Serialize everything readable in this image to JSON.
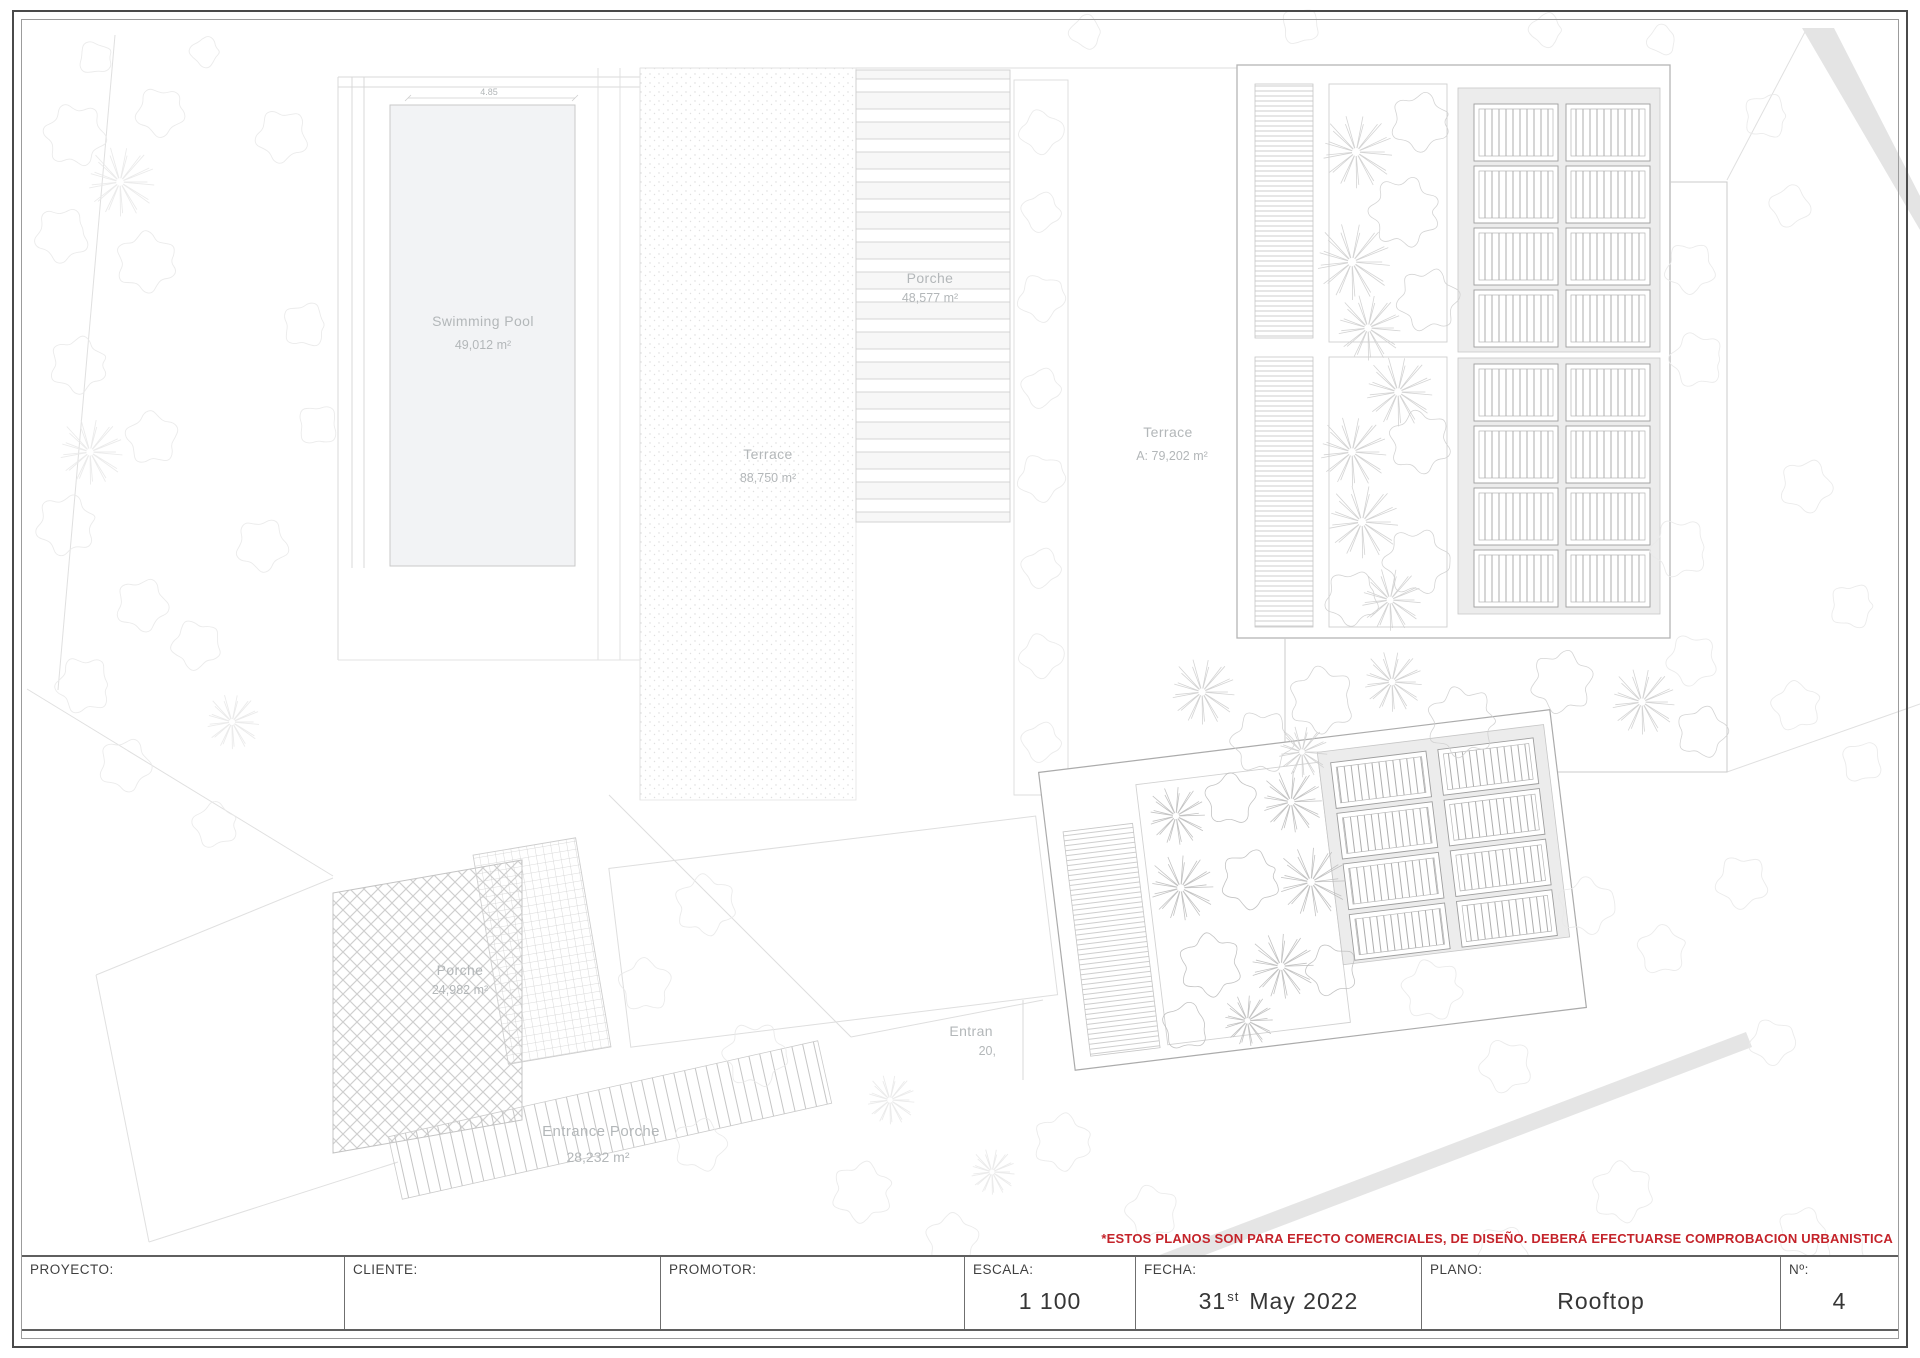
{
  "sheet": {
    "disclaimer": "*ESTOS PLANOS SON PARA EFECTO COMERCIALES, DE DISEÑO. DEBERÁ EFECTUARSE COMPROBACION URBANISTICA",
    "title_block": {
      "labels": [
        "PROYECTO:",
        "CLIENTE:",
        "PROMOTOR:",
        "ESCALA:",
        "FECHA:",
        "PLANO:",
        "Nº:"
      ],
      "escala_value": "1 100",
      "fecha": {
        "day": "31",
        "ordinal": "st",
        "rest": "May 2022"
      },
      "plano_value": "Rooftop",
      "numero_value": "4"
    }
  },
  "plan": {
    "labels": {
      "swimming_pool": {
        "name": "Swimming Pool",
        "area": "49,012 m²"
      },
      "porche_top": {
        "name": "Porche",
        "area": "48,577 m²"
      },
      "terrace_main": {
        "name": "Terrace",
        "area": "88,750 m²"
      },
      "terrace_right": {
        "name": "Terrace",
        "area": "A: 79,202 m²"
      },
      "porche_lower": {
        "name": "Porche",
        "area": "24,982 m²"
      },
      "entrance_porche": {
        "name": "Entrance Porche",
        "area": "28,232 m²"
      },
      "entrance_partial": {
        "line1": "Entran",
        "line2": "20,"
      },
      "pool_dimension": "4.85"
    },
    "colors": {
      "disclaimer_red": "#c4232a",
      "plan_label_gray": "#b3b7b9",
      "plan_line_gray": "#c9c9c9",
      "panel_bg_gray": "#ececec"
    }
  }
}
